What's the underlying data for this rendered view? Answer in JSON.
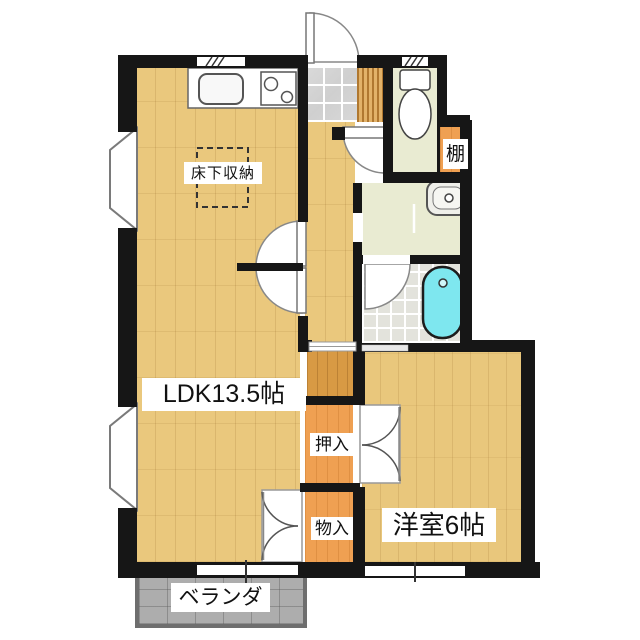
{
  "plan_title": "apartment floor plan",
  "labels": {
    "ldk": "LDK13.5帖",
    "underfloor_storage": "床下収納",
    "oshiire": "押入",
    "monoire": "物入",
    "western_room": "洋室6帖",
    "shelf": "棚",
    "veranda": "ベランダ"
  },
  "colors": {
    "wall": "#161616",
    "wood_light": "#EAC87D",
    "wood_room": "#E9C77C",
    "wood_dark": "#D89A44",
    "closet_orange": "#EFA052",
    "wet_room_floor": "#E9EBD2",
    "bath_tile": "#E3E3DC",
    "bathtub": "#7EE7EF",
    "entrance_tile": "#D5D5D5",
    "veranda_gray": "#ADADAD",
    "label_bg": "#FFFFFF",
    "label_text": "#111111"
  }
}
